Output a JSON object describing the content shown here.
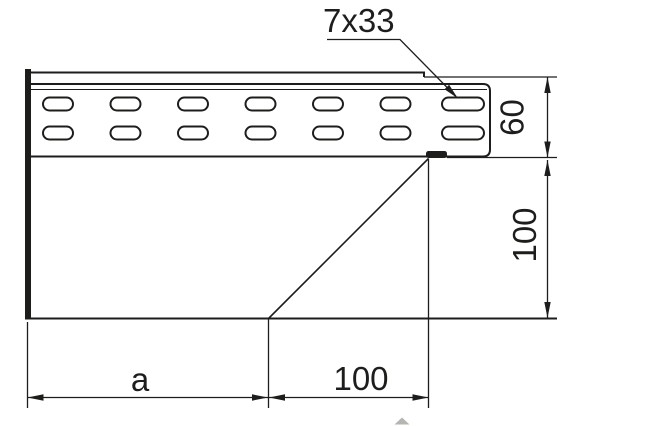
{
  "drawing": {
    "type": "technical-dimension-drawing",
    "labels": {
      "slot_callout": "7x33",
      "rail_height": "60",
      "body_height": "100",
      "bottom_width_left": "a",
      "bottom_width_right": "100"
    },
    "slots": {
      "rows": 2,
      "columns": 7
    },
    "colors": {
      "line": "#1d1d1b",
      "background": "#ffffff",
      "artifact": "#b5b5b2"
    }
  }
}
